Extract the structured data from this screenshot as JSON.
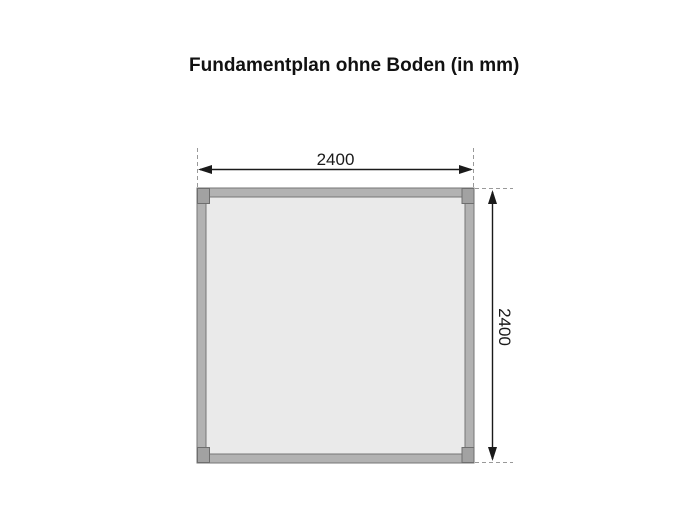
{
  "title": "Fundamentplan ohne Boden (in mm)",
  "diagram": {
    "kind": "foundation-plan-top-view",
    "unit": "mm",
    "width_label": "2400",
    "height_label": "2400",
    "colors": {
      "background": "#ffffff",
      "frame_band": "#b2b2b2",
      "frame_outline": "#757575",
      "interior_fill": "#eaeaea",
      "corner_post": "#a2a2a2",
      "dimension_line": "#1a1a1a",
      "extension_dash": "#999999",
      "title_text": "#111111"
    }
  }
}
